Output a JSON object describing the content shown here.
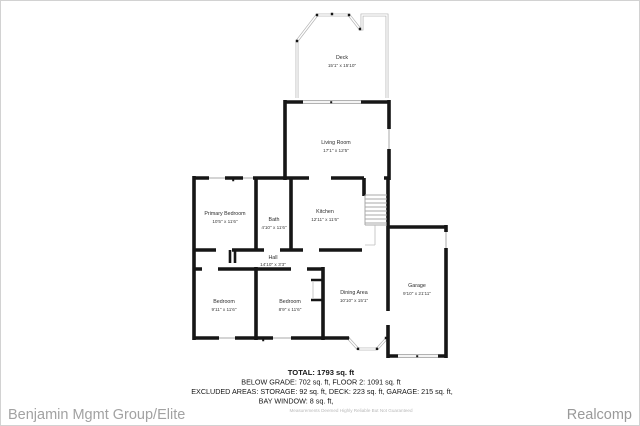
{
  "rooms": [
    {
      "name": "Deck",
      "dims": "15'1\" x 15'10\""
    },
    {
      "name": "Living Room",
      "dims": "17'1\" x 12'5\""
    },
    {
      "name": "Primary Bedroom",
      "dims": "10'5\" x 11'6\""
    },
    {
      "name": "Bath",
      "dims": "4'10\" x 11'6\""
    },
    {
      "name": "Kitchen",
      "dims": "12'11\" x 11'6\""
    },
    {
      "name": "Hall",
      "dims": "14'10\" x 3'3\""
    },
    {
      "name": "Bedroom",
      "dims": "9'11\" x 11'6\""
    },
    {
      "name": "Bedroom",
      "dims": "8'9\" x 11'6\""
    },
    {
      "name": "Dining Area",
      "dims": "10'10\" x 15'1\""
    },
    {
      "name": "Garage",
      "dims": "9'10\" x 21'11\""
    }
  ],
  "summary": {
    "total": "TOTAL: 1793 sq. ft",
    "below_grade_floor2": "BELOW GRADE: 702 sq. ft, FLOOR 2: 1091 sq. ft",
    "excluded_areas": "EXCLUDED AREAS: STORAGE: 92 sq. ft, DECK: 223 sq. ft, GARAGE: 215 sq. ft,",
    "bay_window": "BAY WINDOW: 8 sq. ft,",
    "disclaimer": "Measurements Deemed Highly Reliable But Not Guaranteed"
  },
  "footer": {
    "company": "Benjamin Mgmt Group/Elite",
    "provider": "Realcomp"
  },
  "colors": {
    "wall": "#161616",
    "thin_line": "#a8a8a8",
    "deck_line": "#b3b3b3",
    "label_text": "#2c2c2c",
    "summary_text": "#161616",
    "disclaimer_text": "#bababa",
    "footer_text": "#a2a2a2",
    "background": "#ffffff"
  }
}
